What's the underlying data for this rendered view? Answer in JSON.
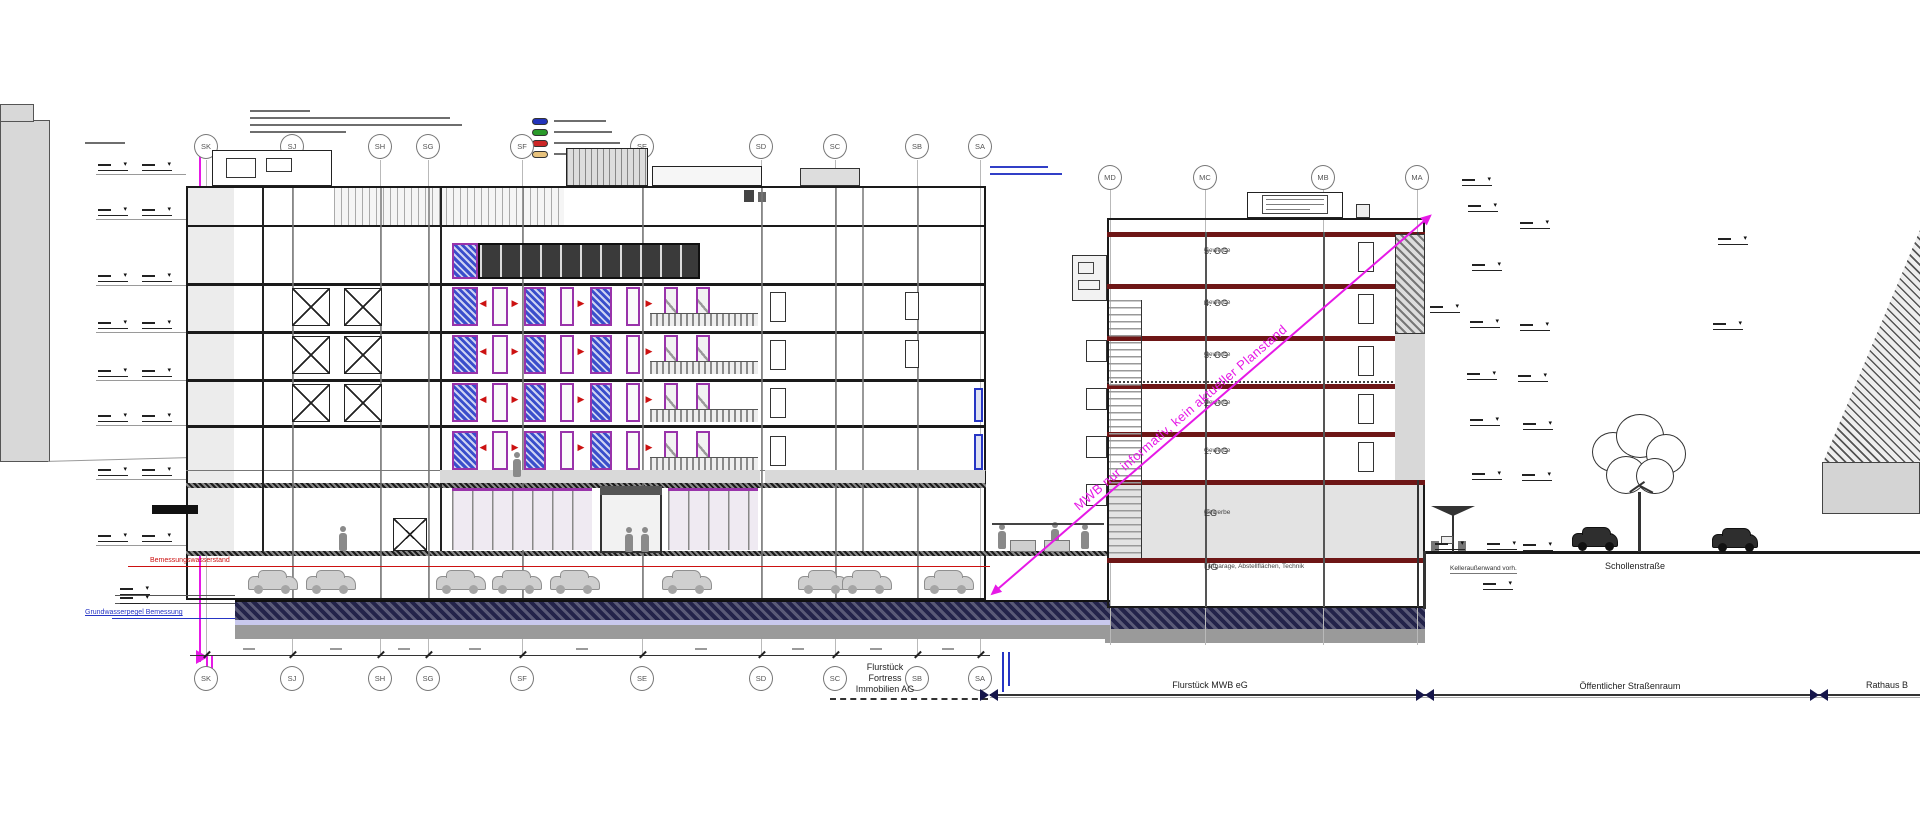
{
  "grids": {
    "left": [
      "SK",
      "SJ",
      "SH",
      "SG",
      "SF",
      "SE",
      "SD",
      "SC",
      "SB",
      "SA"
    ],
    "right": [
      "MD",
      "MC",
      "MB",
      "MA"
    ]
  },
  "right_building": {
    "floors": [
      {
        "name": "5. OG",
        "use": "Gewerbe"
      },
      {
        "name": "4. OG",
        "use": "Gewerbe"
      },
      {
        "name": "3. OG",
        "use": "Gewerbe"
      },
      {
        "name": "2. OG",
        "use": "Gewerbe"
      },
      {
        "name": "1. OG",
        "use": "Gewerbe"
      },
      {
        "name": "EG",
        "use": "Gewerbe"
      },
      {
        "name": "UG",
        "use": "Tiefgarage, Abstellflächen, Technik"
      }
    ]
  },
  "watermark": "MWB nur informativ, kein aktueller Planstand",
  "parcels": {
    "left": {
      "line1": "Flurstück",
      "line2": "Fortress",
      "line3": "Immobilien AG"
    },
    "mwb": "Flurstück MWB eG",
    "street_space": "Öffentlicher Straßenraum",
    "rathaus": "Rathaus B"
  },
  "street_name": "Schollenstraße",
  "annotations": {
    "red_level": "Bemessungswasserstand",
    "blue_level": "Grundwasserpegel Bemessung",
    "cellar": "Kelleraußenwand vorh."
  },
  "colors": {
    "watermark_magenta": "#e619e6",
    "floor_slab_maroon": "#6e1616",
    "window_frame_purple": "#9933aa",
    "window_hatch_blue": "#3a4ecb",
    "foundation_navy": "#23234a",
    "groundwater_red": "#cc1111",
    "groundwater_blue": "#2635c4",
    "legend_swatches": [
      "#2233bb",
      "#2a9a2a",
      "#cc2626",
      "#e7c27d"
    ]
  }
}
